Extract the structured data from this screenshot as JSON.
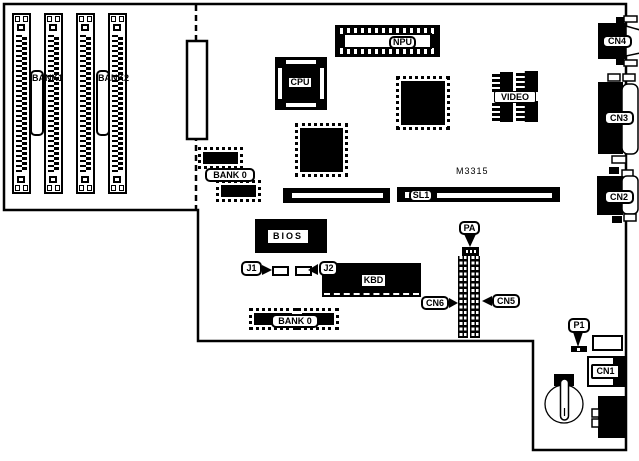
{
  "board": {
    "model": "M3315"
  },
  "memory_banks": {
    "bank1": "BANK1",
    "bank2": "BANK2",
    "bank0_top": "BANK 0",
    "bank0_bottom": "BANK 0"
  },
  "chips": {
    "cpu": "CPU",
    "npu": "NPU",
    "video": "VIDEO",
    "bios": "BIOS",
    "kbd": "KBD"
  },
  "slots": {
    "sl1": "SL1"
  },
  "jumpers": {
    "j1": "J1",
    "j2": "J2",
    "pa": "PA",
    "p1": "P1"
  },
  "connectors": {
    "cn1": "CN1",
    "cn2": "CN2",
    "cn3": "CN3",
    "cn4": "CN4",
    "cn5": "CN5",
    "cn6": "CN6"
  },
  "colors": {
    "ink": "#000000",
    "background": "#ffffff"
  }
}
